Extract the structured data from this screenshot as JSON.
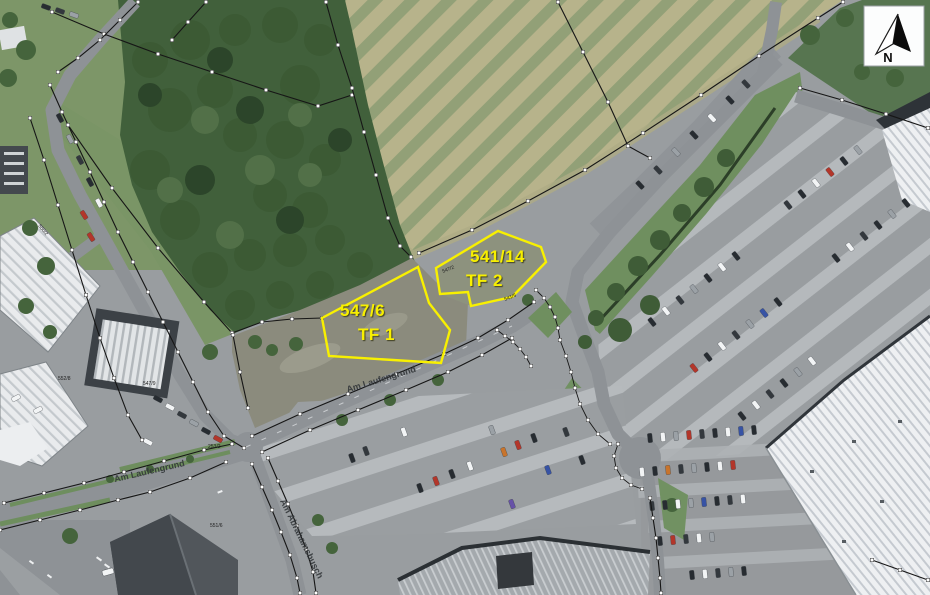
{
  "map": {
    "parcels": [
      {
        "number": "547/6",
        "teilflaeche": "TF 1"
      },
      {
        "number": "541/14",
        "teilflaeche": "TF 2"
      }
    ],
    "streets": [
      {
        "name": "Am Laufengrund"
      },
      {
        "name": "Am Laufengrund"
      },
      {
        "name": "Am Abrahamsbusch"
      }
    ],
    "small_parcel_labels": [
      "550/2",
      "552/8",
      "547/9",
      "253/2",
      "547/2",
      "541/5",
      "551/6"
    ],
    "north_arrow": {
      "label": "N"
    },
    "colors": {
      "parcel_outline": "#f8f000",
      "boundary_line": "#161616",
      "survey_point": "#ffffff",
      "field_light": "#b7b38b",
      "field_green": "#92a077",
      "forest": "#3f5c38",
      "asphalt": "#8e9296"
    }
  }
}
